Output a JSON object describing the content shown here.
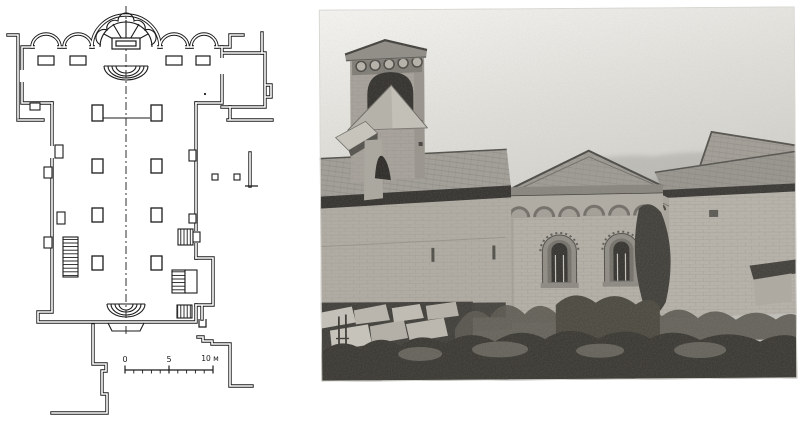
{
  "figure": {
    "plan": {
      "scale_bar": {
        "zero": "0",
        "five": "5",
        "ten": "10 м"
      },
      "ink_color": "#1b1b1b",
      "paper_color": "#ffffff"
    },
    "photo": {
      "tone_sky": "#e9e8e3",
      "tone_wall": "#b4b0a7",
      "tone_roof": "#9d9a93",
      "tone_shadow": "#2f2d29",
      "tone_vegetation": "#39372f"
    }
  }
}
